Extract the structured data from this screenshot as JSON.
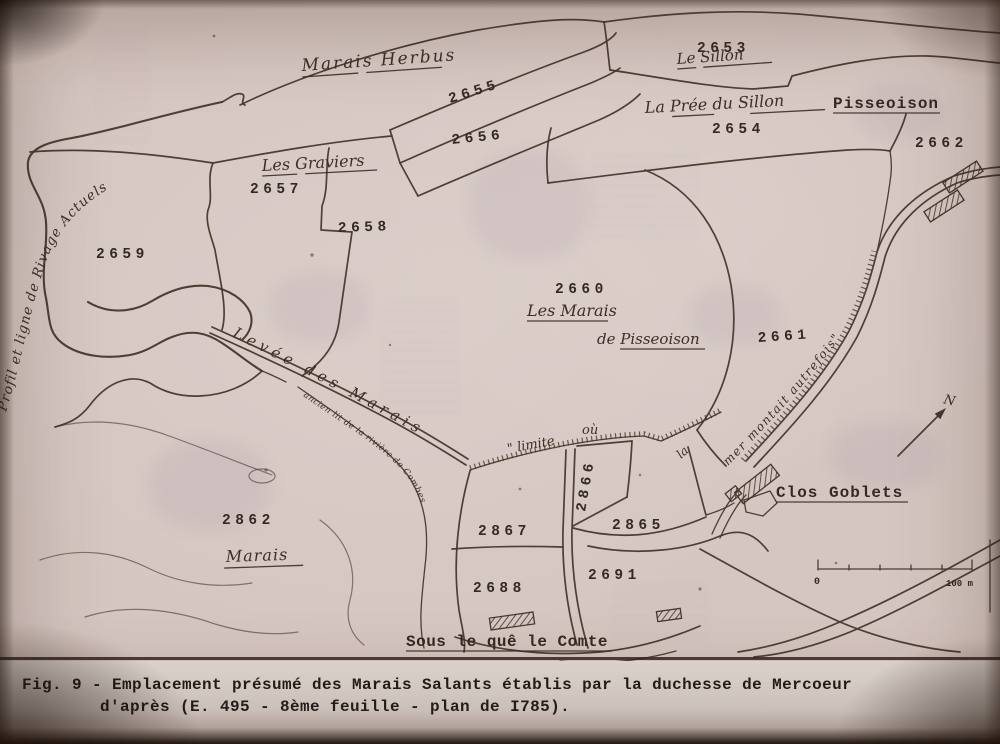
{
  "figure": {
    "caption_line1": "Fig. 9 - Emplacement présumé des Marais Salants établis par la duchesse de Mercoeur",
    "caption_line2": "d'après (E. 495 - 8ème feuille - plan de I785)."
  },
  "map": {
    "parcels": [
      {
        "number": "2653"
      },
      {
        "number": "2654"
      },
      {
        "number": "2655"
      },
      {
        "number": "2656"
      },
      {
        "number": "2657"
      },
      {
        "number": "2658"
      },
      {
        "number": "2659"
      },
      {
        "number": "2660"
      },
      {
        "number": "2661"
      },
      {
        "number": "2662"
      },
      {
        "number": "2862"
      },
      {
        "number": "2866"
      },
      {
        "number": "2865"
      },
      {
        "number": "2867"
      },
      {
        "number": "2688"
      },
      {
        "number": "2691"
      }
    ],
    "place_names": {
      "marais_herbus": "Marais Herbus",
      "le_sillon": "Le Sillon",
      "la_pree_du_sillon": "La Prée du Sillon",
      "pisseoison": "Pisseoison",
      "les_graviers": "Les Graviers",
      "les_marais_line1": "Les Marais",
      "les_marais_line2": "de Pisseoison",
      "clos_goblets": "Clos Goblets",
      "marais": "Marais",
      "sous_le_que_le_comte": "Sous le quê le Comte"
    },
    "annotations": {
      "profil": "Profil et ligne de Rivage Actuels",
      "levee": "Levée des Marais",
      "ancien_lit": "ancien lit de la rivière de Combes",
      "limite_part1": "\" limite",
      "limite_part2": "où",
      "limite_part3": "la",
      "limite_part4": "mer montait autrefois\"",
      "north": "N"
    },
    "scale_bar": {
      "start": "0",
      "end": "100 m"
    }
  },
  "colors": {
    "paper": "#d5c6c1",
    "ink": "#45382d",
    "caption_ink": "#241c18"
  }
}
